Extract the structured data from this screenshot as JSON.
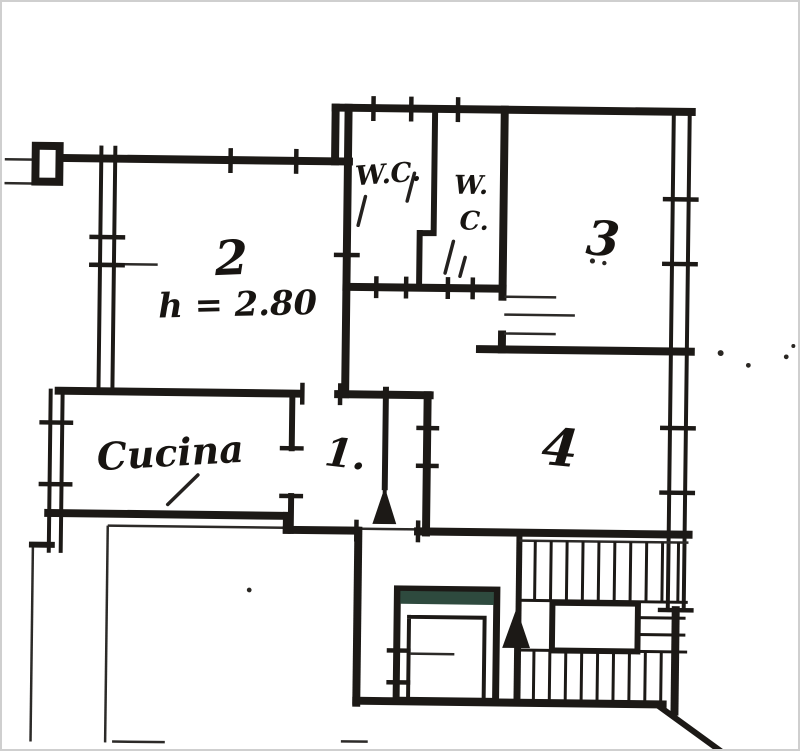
{
  "colors": {
    "ink": "#1c1916",
    "paper": "#ffffff",
    "frame": "#cfcfcf",
    "elevator_bar": "#2e4a3e"
  },
  "labels": {
    "room1": "1.",
    "room2": "2",
    "room3": "3",
    "room4": "4",
    "wc1": "W.C.",
    "wc2_line1": "W.",
    "wc2_line2": "C.",
    "kitchen": "Cucina",
    "ceiling_height": "h = 2.80"
  }
}
